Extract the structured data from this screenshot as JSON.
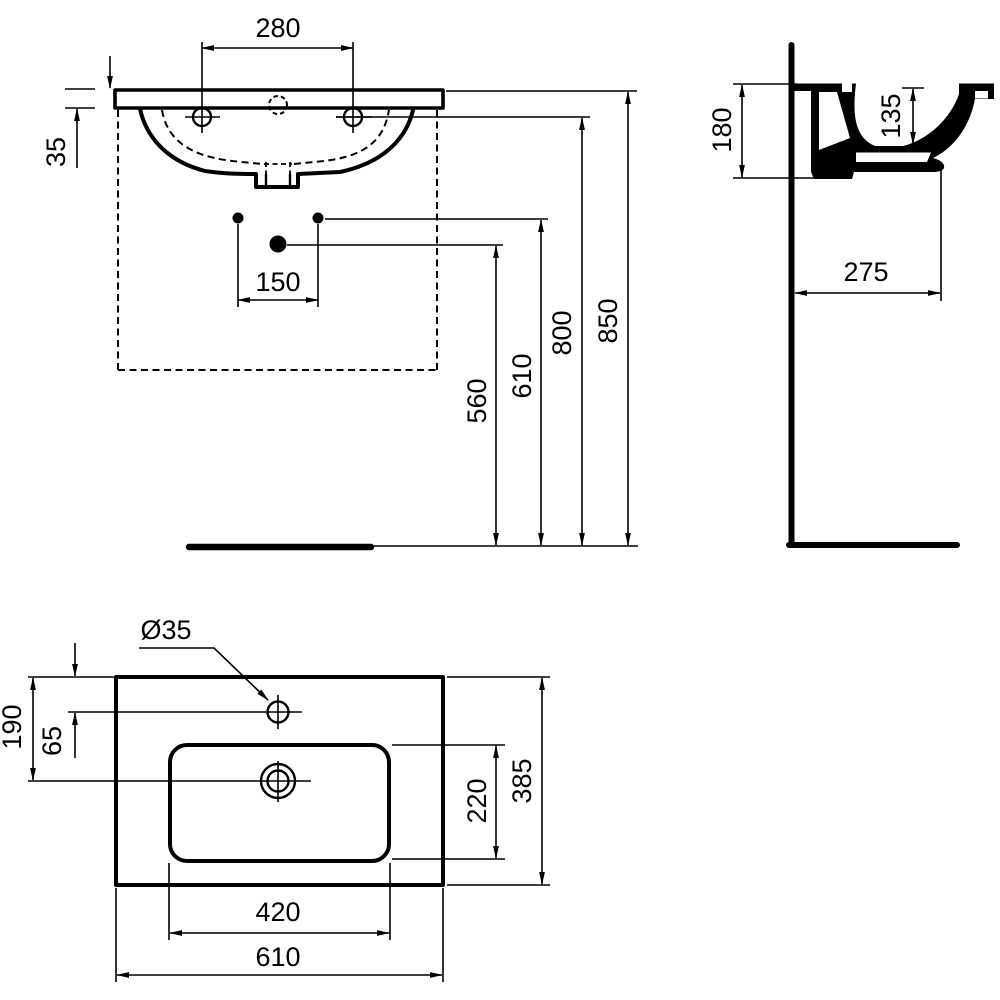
{
  "drawing": {
    "type": "washbasin-technical-drawing",
    "colors": {
      "line": "#000000",
      "background": "#ffffff"
    },
    "front": {
      "tap_spacing": "280",
      "rim_thickness": "35",
      "fixing_spacing": "150",
      "outlet_height": "560",
      "fixing_height": "610",
      "tap_height": "800",
      "rim_height": "850"
    },
    "side": {
      "overall_depth": "180",
      "bowl_depth": "135",
      "wall_clearance": "275"
    },
    "top": {
      "tap_hole_diameter": "Ø35",
      "outlet_offset": "190",
      "tap_offset": "65",
      "bowl_depth": "220",
      "overall_depth": "385",
      "bowl_width": "420",
      "overall_width": "610"
    }
  }
}
